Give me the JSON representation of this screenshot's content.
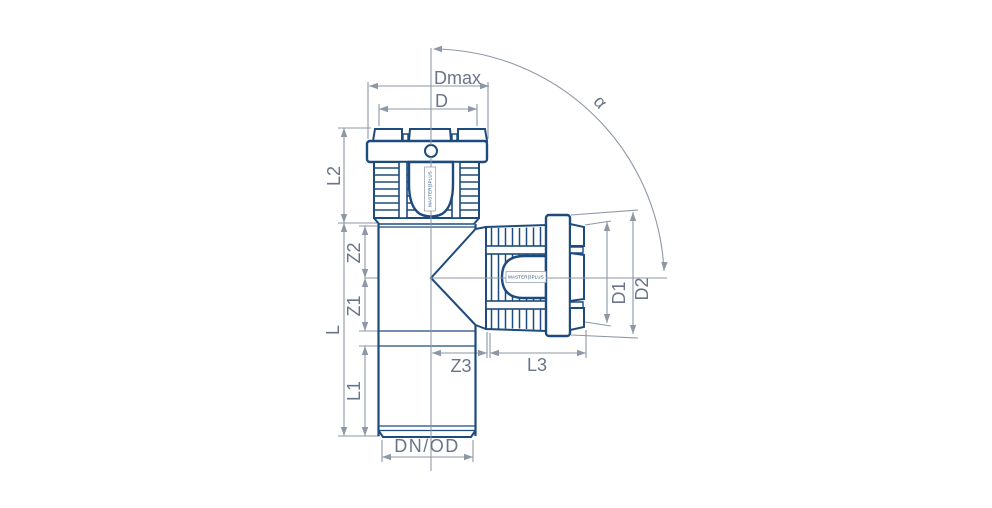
{
  "colors": {
    "outline": "#1d4b7d",
    "dimension": "#8e97a6",
    "text": "#6a7488",
    "bg": "#ffffff"
  },
  "product_label": "MASTER|3PLUS",
  "labels": {
    "dmax": "Dmax",
    "d": "D",
    "l2": "L2",
    "z2": "Z2",
    "z1": "Z1",
    "l": "L",
    "l1": "L1",
    "dn_od": "DN/OD",
    "z3": "Z3",
    "l3": "L3",
    "d1": "D1",
    "d2": "D2",
    "alpha": "α"
  }
}
